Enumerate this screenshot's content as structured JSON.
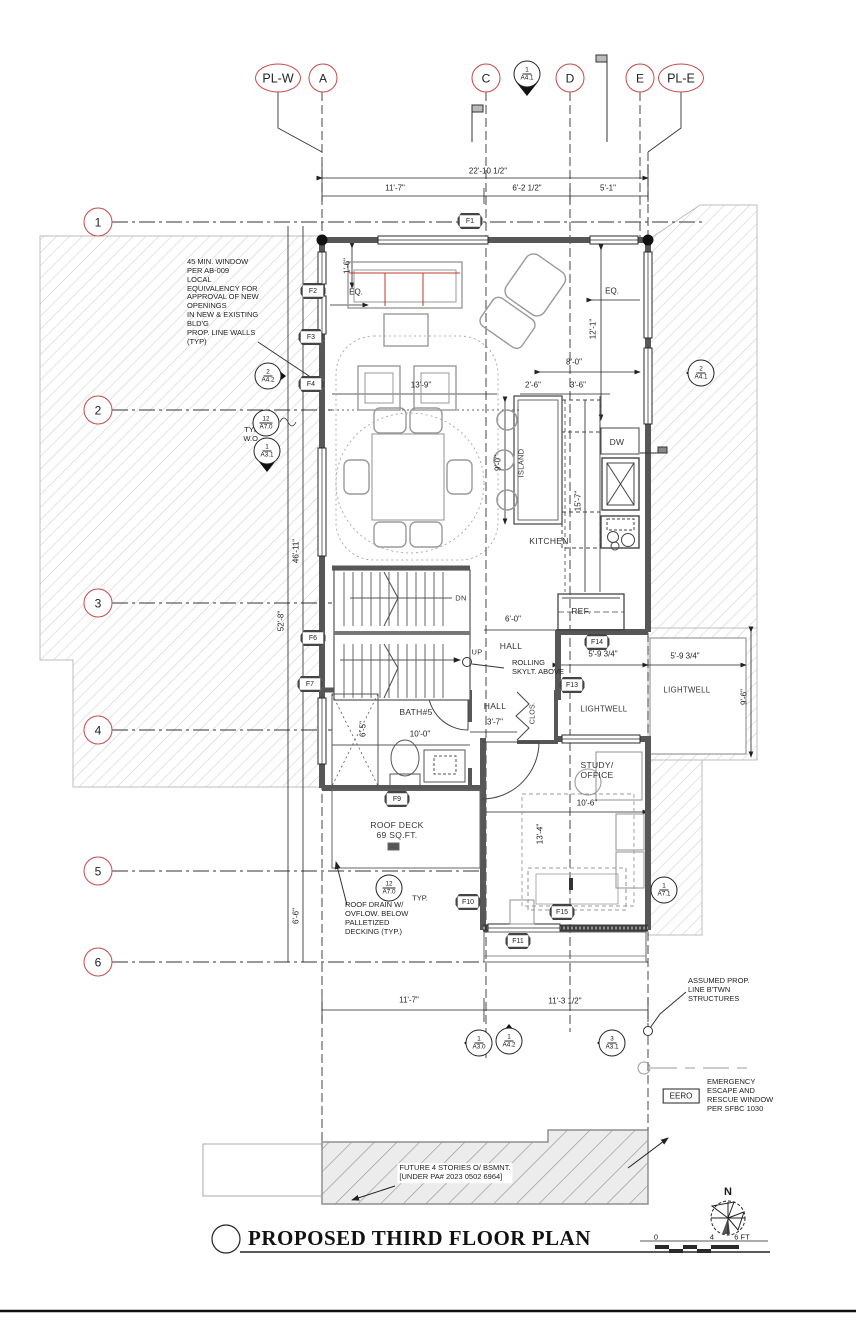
{
  "drawing": {
    "title": "PROPOSED THIRD FLOOR PLAN",
    "north_label": "N",
    "scale_bar": {
      "zero": "0",
      "four": "4",
      "six": "6 FT"
    }
  },
  "colors": {
    "grid_bubble_red": "#c64a4a",
    "sofa_accent_red": "#c0392b",
    "hatch_gray": "#cccccc"
  },
  "grid": {
    "cols": {
      "plw": "PL-W",
      "a": "A",
      "c": "C",
      "d": "D",
      "e": "E",
      "ple": "PL-E"
    },
    "rows": {
      "r1": "1",
      "r2": "2",
      "r3": "3",
      "r4": "4",
      "r5": "5",
      "r6": "6"
    }
  },
  "dims": {
    "top_overall": "22'-10 1/2\"",
    "top_ac": "11'-7\"",
    "top_cd": "6'-2 1/2\"",
    "top_de": "5'-1\"",
    "inset_16": "1'-6\"",
    "eq_left": "EQ.",
    "eq_right": "EQ.",
    "living_139": "13'-9\"",
    "east_121": "12'-1\"",
    "kit_80": "8'-0\"",
    "kit_26": "2'-6\"",
    "kit_36": "3'-6\"",
    "island_90": "9'-0\"",
    "counter_157": "15'-7\"",
    "left_4611": "46'-11\"",
    "left_528": "52'-8\"",
    "hall_60": "6'-0\"",
    "lw_in_5934": "5'-9 3/4\"",
    "lw_out_5934": "5'-9 3/4\"",
    "lw_96": "9'-6\"",
    "bath_65": "6'-5\"",
    "bath_100": "10'-0\"",
    "hall_37": "3'-7\"",
    "study_106": "10'-6\"",
    "study_134": "13'-4\"",
    "left_66": "6'-6\"",
    "bot_117": "11'-7\"",
    "bot_1132": "11'-3 1/2\""
  },
  "rooms": {
    "kitchen": "KITCHEN",
    "island": "ISLAND",
    "dw": "DW",
    "ref": "REF.",
    "dn": "DN",
    "up": "UP",
    "hall1": "HALL",
    "hall2": "HALL",
    "clos": "CLOS.",
    "bath": "BATH#5",
    "lightwell_in": "LIGHTWELL",
    "lightwell_out": "LIGHTWELL",
    "study": "STUDY/\nOFFICE",
    "roof_deck": "ROOF DECK\n69 SQ.FT."
  },
  "notes": {
    "prop_walls": "45 MIN. WINDOW\nPER AB-009\nLOCAL\nEQUIVALENCY FOR\nAPPROVAL OF NEW\nOPENINGS\nIN NEW & EXISTING\nBLD'G\nPROP. LINE WALLS\n(TYP)",
    "typ_wo": "TYP.\nW.O.",
    "rolling": "ROLLING\nSKYLT. ABOVE",
    "roof_drain": "ROOF DRAIN W/\nOVFLOW. BELOW\nPALLETIZED\nDECKING (TYP.)",
    "typ_deck": "TYP.",
    "assumed": "ASSUMED PROP.\nLINE B'TWN\nSTRUCTURES",
    "eero_tag": "EERO",
    "eero_text": "EMERGENCY\nESCAPE AND\nRESCUE WINDOW\nPER SFBC 1030",
    "future": "FUTURE 4 STORIES O/ BSMNT.\n[UNDER PA# 2023 0502 6964]"
  },
  "markers": {
    "f1": "F1",
    "f2": "F2",
    "f3": "F3",
    "f4": "F4",
    "f6": "F6",
    "f7": "F7",
    "f9": "F9",
    "f10": "F10",
    "f11": "F11",
    "f13": "F13",
    "f14": "F14",
    "f15": "F15",
    "a41_top": {
      "num": "1",
      "sheet": "A4.1"
    },
    "a42_left": {
      "num": "2",
      "sheet": "A4.2"
    },
    "a70_typ": {
      "num": "12",
      "sheet": "A7.0"
    },
    "a31_left": {
      "num": "1",
      "sheet": "A3.1"
    },
    "a41_right": {
      "num": "2",
      "sheet": "A4.1"
    },
    "a70_deck": {
      "num": "12",
      "sheet": "A7.0"
    },
    "a71_study": {
      "num": "1",
      "sheet": "A7.1"
    },
    "a30_bot": {
      "num": "1",
      "sheet": "A3.0"
    },
    "a42_bot": {
      "num": "1",
      "sheet": "A4.2"
    },
    "a31_bot": {
      "num": "3",
      "sheet": "A3.1"
    }
  }
}
